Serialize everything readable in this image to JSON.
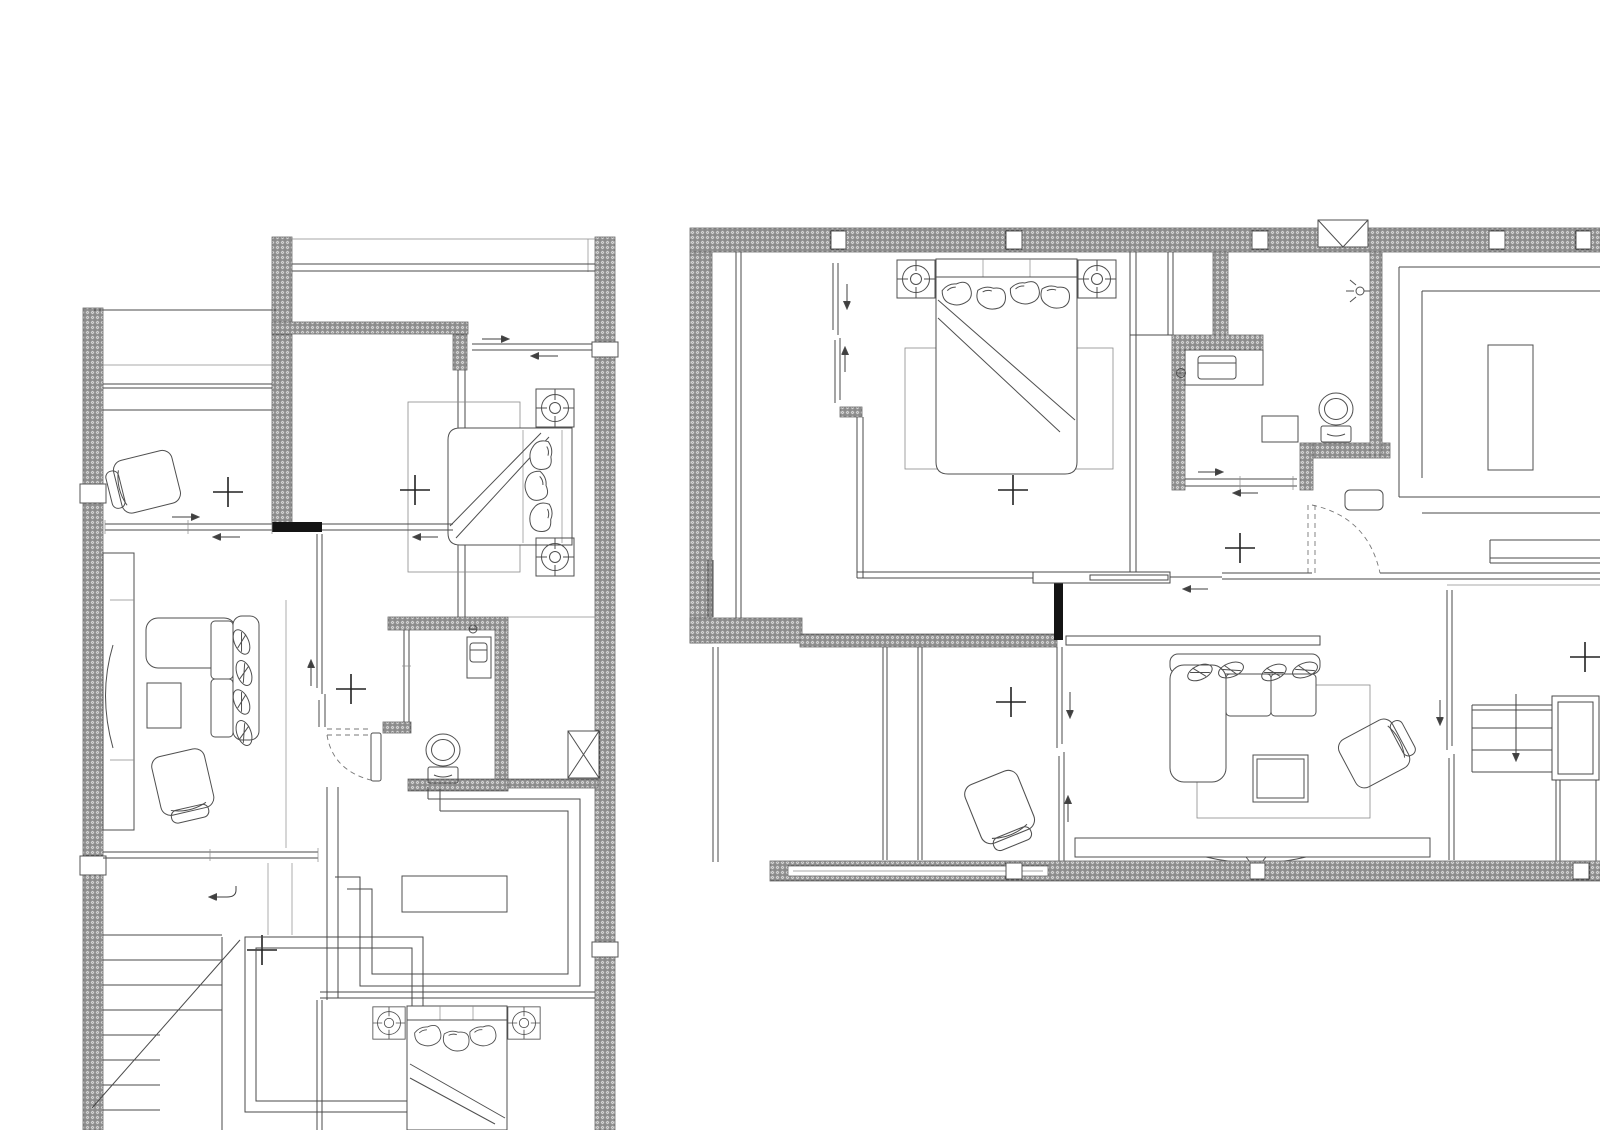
{
  "document": {
    "kind": "architectural floor plan sheet",
    "sheet_width_px": 1600,
    "sheet_height_px": 1130,
    "visible_text": "none",
    "background": "#ffffff"
  },
  "colors": {
    "background": "#ffffff",
    "line": "#4a4a4a",
    "thin_line": "#8b8b8b",
    "wall_hatch_base": "#e4e4e4",
    "wall_hatch_stroke": "#a2a2a2",
    "solid_wall": "#141414",
    "marker_cross": "#222222"
  },
  "legend_symbols": [
    "hatched-wall",
    "column-blockout-square",
    "center-cross-marker",
    "sliding-door-track",
    "hinged-door-swing-arc",
    "double-line-window",
    "nightstand-fixture (square with circled crosshair)",
    "direction-arrow",
    "vent-shaft-box-with-x",
    "stair-treads-with-down-arrow"
  ],
  "plans": [
    {
      "name": "floor-plan-left",
      "position": "left half of sheet, cropped at sheet bottom",
      "rooms": [
        {
          "name": "balcony-top",
          "features": [
            "double-line railing"
          ]
        },
        {
          "name": "bedroom-upper",
          "furniture": [
            "double-bed (head at right wall)",
            "nightstand-fixture",
            "nightstand-fixture",
            "rug"
          ],
          "openings": [
            "top sliding window"
          ]
        },
        {
          "name": "study-room",
          "furniture": [
            "armchair (rotated)",
            "wardrobe front lines"
          ],
          "openings": [
            "bottom sliding window"
          ]
        },
        {
          "name": "living-area",
          "furniture": [
            "l-shaped-sofa with leaf cushions",
            "coffee-table",
            "armchair (rotated)",
            "tall-side-cabinet"
          ]
        },
        {
          "name": "hallway",
          "features": [
            "pocket-door tracks",
            "center-cross-marker x2"
          ]
        },
        {
          "name": "bathroom",
          "furniture": [
            "toilet",
            "vanity-with-sink",
            "faucet"
          ],
          "doors": [
            "hinged door with dashed swing arc"
          ],
          "features": [
            "vent-shaft-box-with-x"
          ]
        },
        {
          "name": "tatami-room",
          "furniture": [
            "low-table"
          ],
          "features": [
            "nested double-line border"
          ]
        },
        {
          "name": "stairwell",
          "features": [
            "lower flight treads",
            "landing platform",
            "upper flight treads",
            "return-arrow",
            "diagonal break line"
          ]
        },
        {
          "name": "bedroom-lower",
          "furniture": [
            "double-bed (head at top, cropped)",
            "nightstand-fixture",
            "nightstand-fixture"
          ]
        }
      ]
    },
    {
      "name": "floor-plan-right",
      "position": "right half of sheet, cropped at sheet right edge",
      "rooms": [
        {
          "name": "master-bedroom",
          "furniture": [
            "double-bed (head at top wall)",
            "nightstand-fixture",
            "nightstand-fixture",
            "rug"
          ],
          "openings": [
            "vertical sliding door at left",
            "pocket door to hall"
          ]
        },
        {
          "name": "wardrobe-strip-left",
          "features": [
            "closet front lines"
          ]
        },
        {
          "name": "bathroom",
          "furniture": [
            "toilet",
            "vanity-with-sink",
            "faucet",
            "shower-head",
            "shelf"
          ],
          "features": [
            "vent-shaft-box-with-x on top wall"
          ],
          "openings": [
            "bottom sliding door"
          ]
        },
        {
          "name": "hallway",
          "features": [
            "center-cross-marker",
            "hinged door with dashed swing arc",
            "floor-mat"
          ]
        },
        {
          "name": "dining-kitchen-area",
          "furniture": [
            "island-counter",
            "counter-band"
          ],
          "features": [
            "nested corner lines"
          ]
        },
        {
          "name": "living-area",
          "furniture": [
            "l-shaped-sofa with leaf cushions",
            "coffee-table",
            "armchair (rotated)",
            "rug",
            "tv-console",
            "curved-tv",
            "sofa-back-console"
          ]
        },
        {
          "name": "multi-purpose-room",
          "furniture": [
            "armchair (rotated)"
          ],
          "features": [
            "sliding partition tracks",
            "center-cross-marker"
          ]
        },
        {
          "name": "staircase",
          "features": [
            "treads",
            "long down-arrow",
            "shaft double square",
            "center-cross-marker"
          ]
        },
        {
          "name": "balcony-bottom",
          "features": [
            "hatched parapet with column squares",
            "window strip"
          ]
        }
      ]
    }
  ],
  "counts": {
    "center_cross_markers": 8,
    "beds": 3,
    "toilets": 2,
    "l_shaped_sofas": 2,
    "armchairs": 4,
    "nightstand_fixtures": 6,
    "staircases": 2,
    "vent_boxes": 2
  }
}
